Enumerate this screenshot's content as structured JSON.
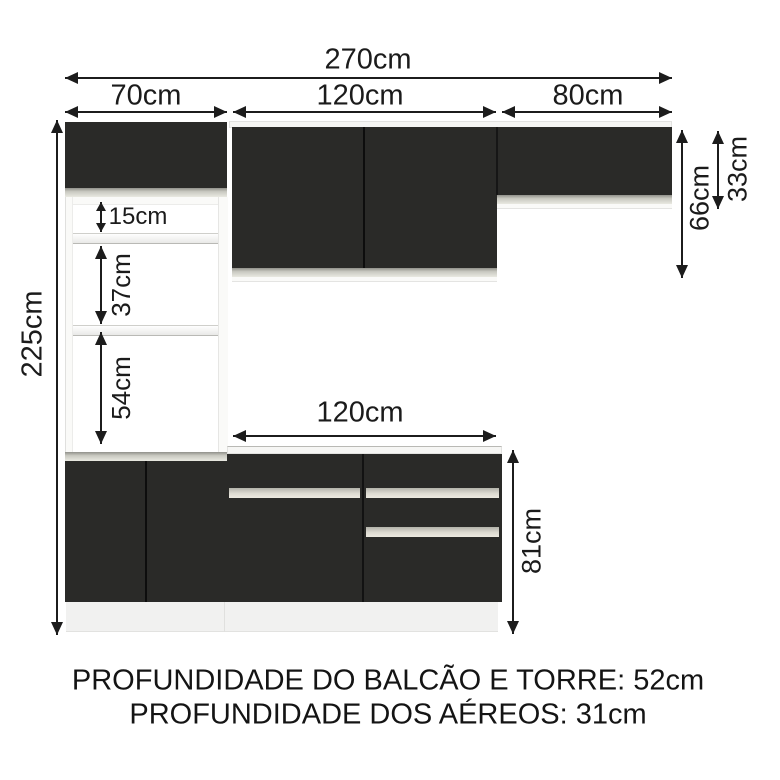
{
  "diagram": {
    "top_dims": {
      "total_width": "270cm",
      "tower_width": "70cm",
      "wall_mid_width": "120cm",
      "wall_right_width": "80cm"
    },
    "left_dims": {
      "total_height": "225cm"
    },
    "tower_dims": {
      "niche_top": "15cm",
      "niche_middle": "37cm",
      "niche_bottom": "54cm"
    },
    "right_dims": {
      "wall_cabinet_height": "66cm",
      "wall_right_height": "33cm"
    },
    "counter_dims": {
      "counter_width": "120cm",
      "counter_height": "81cm"
    },
    "notes": {
      "depth_counter_tower": "PROFUNDIDADE DO BALCÃO E TORRE: 52cm",
      "depth_wall": "PROFUNDIDADE DOS AÉREOS: 31cm"
    },
    "colors": {
      "cabinet_black": "#2a2a28",
      "trim_gray": "#d8d8d0",
      "plinth_gray": "#f1f1f0",
      "line_black": "#1c1c1c",
      "background": "#ffffff"
    }
  }
}
